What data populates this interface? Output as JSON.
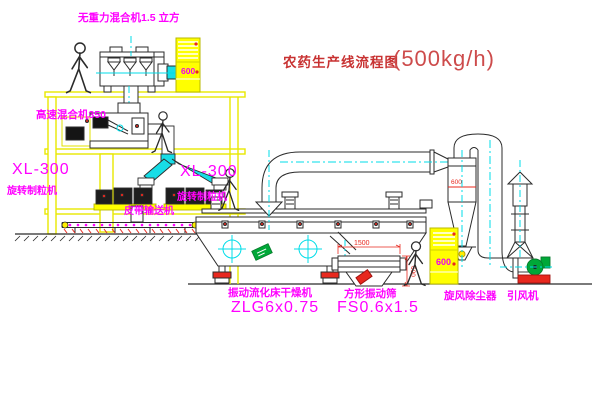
{
  "title": {
    "name": "农药生产线流程图",
    "capacity": "(500kg/h)"
  },
  "equipment": {
    "gravity_mixer": {
      "label": "无重力混合机1.5 立方"
    },
    "high_speed_mixer": {
      "label": "高速混合机350"
    },
    "granulator_left": {
      "model": "XL-300",
      "name": "旋转制粒机"
    },
    "granulator_right": {
      "model": "XL-300",
      "name": "旋转制粒机"
    },
    "belt_conveyor": {
      "name": "皮带输送机"
    },
    "fluid_bed_dryer": {
      "name": "振动流化床干燥机",
      "model": "ZLG6x0.75"
    },
    "vibrating_sieve": {
      "name": "方形振动筛",
      "model": "FS0.6x1.5"
    },
    "cyclone": {
      "name": "旋风除尘器"
    },
    "fan": {
      "name": "引风机"
    },
    "control_cabinet_top": {
      "panel_text": "600"
    },
    "control_cabinet_right": {
      "panel_text": "600"
    }
  },
  "dimensions": {
    "sieve_length": "1500",
    "sieve_width": "600",
    "cyclone_line": "600"
  },
  "colors": {
    "structure_yellow": "#e8e800",
    "centerline_cyan": "#00dde8",
    "label_magenta": "#ff00ff",
    "annotation_red": "#e8281e",
    "title_red": "#c83232",
    "machine_line": "#2b2b2b",
    "accent_green": "#00a838"
  }
}
